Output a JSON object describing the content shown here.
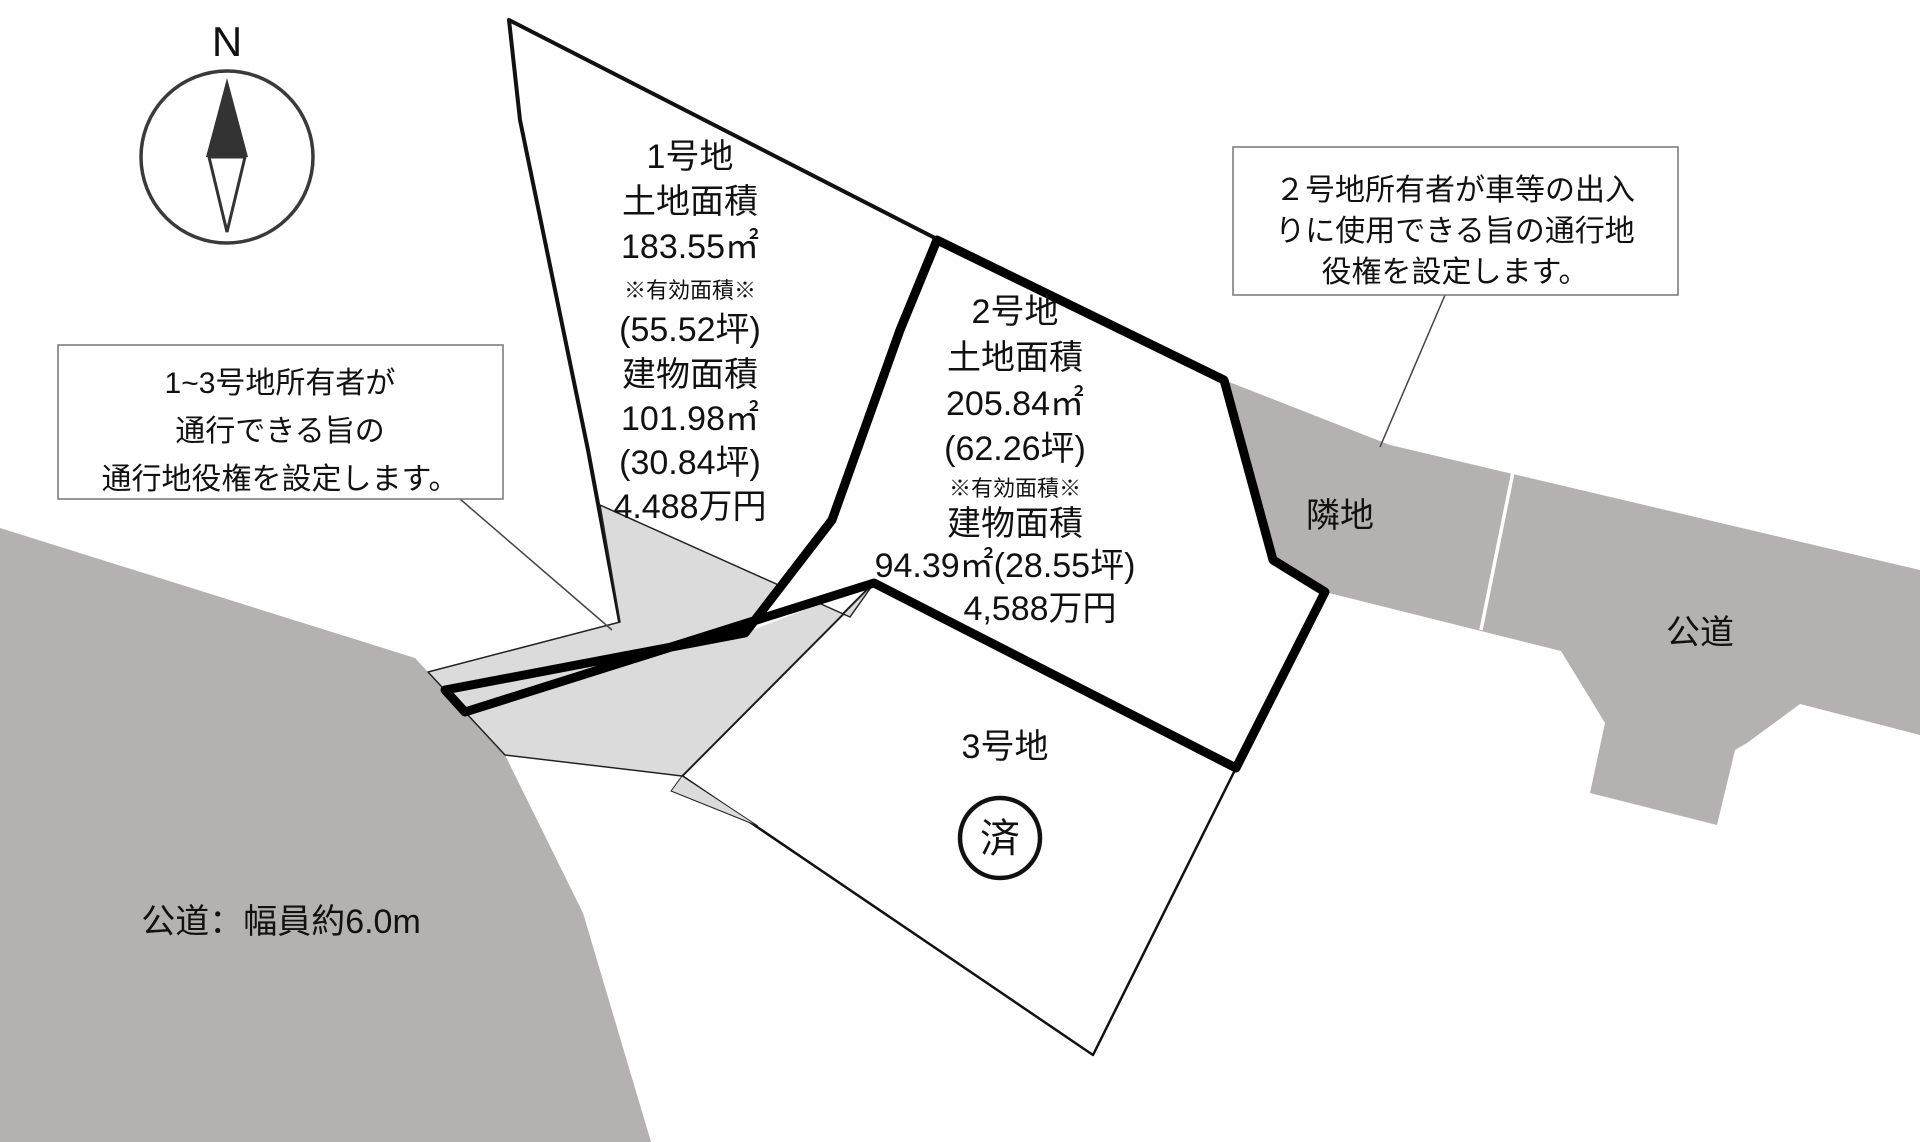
{
  "compass": {
    "label": "N"
  },
  "lot1": {
    "lines": [
      "1号地",
      "土地面積",
      "183.55㎡",
      "※有効面積※",
      "(55.52坪)",
      "建物面積",
      "101.98㎡",
      "(30.84坪)",
      "4.488万円"
    ]
  },
  "lot2": {
    "lines": [
      "2号地",
      "土地面積",
      "205.84㎡",
      "(62.26坪)",
      "※有効面積※",
      "建物面積",
      "94.39㎡(28.55坪)",
      "4,588万円"
    ]
  },
  "lot3": {
    "label": "3号地",
    "stamp": "済"
  },
  "notes": {
    "left": {
      "lines": [
        "1~3号地所有者が",
        "通行できる旨の",
        "通行地役権を設定します。"
      ]
    },
    "right": {
      "lines": [
        "２号地所有者が車等の出入",
        "りに使用できる旨の通行地",
        "役権を設定します。"
      ]
    }
  },
  "areas": {
    "neighbor": "隣地",
    "road_right": "公道",
    "road_left": "公道：幅員約6.0m"
  },
  "colors": {
    "dark_gray": "#b6b1b1",
    "light_gray": "#dbdbdb",
    "line": "#111111",
    "thick_line": "#000000",
    "box_border": "#777777"
  }
}
